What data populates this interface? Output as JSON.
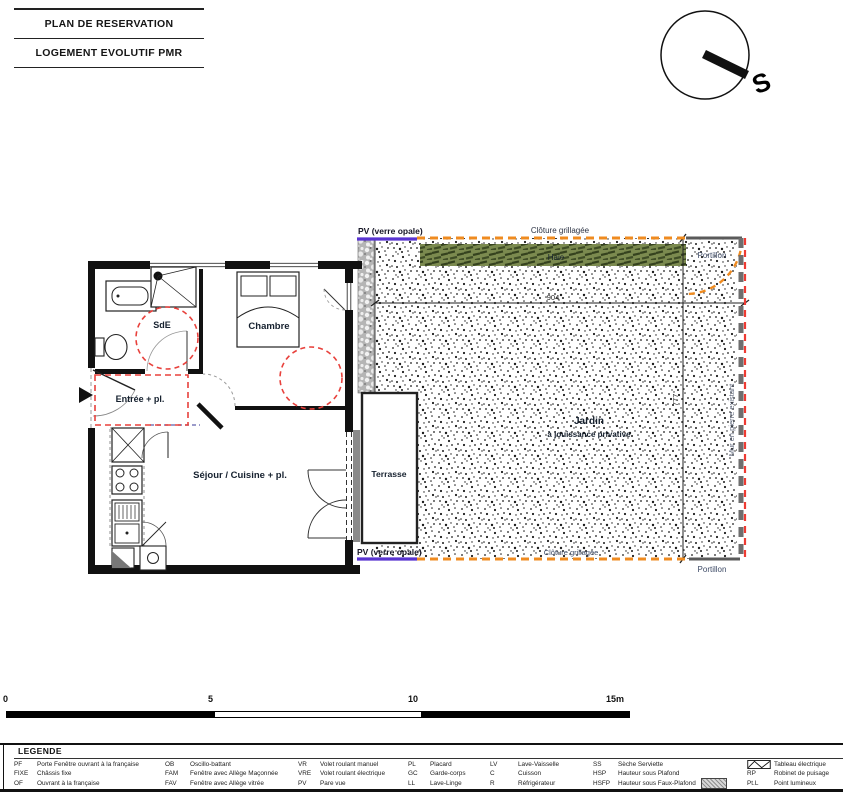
{
  "title_block": {
    "line1": "PLAN DE RESERVATION",
    "line2": "LOGEMENT EVOLUTIF PMR"
  },
  "north_arrow": {
    "letter": "S"
  },
  "plan": {
    "rooms": {
      "sde": "SdE",
      "chambre": "Chambre",
      "entree": "Entrée + pl.",
      "sejour": "Séjour / Cuisine + pl.",
      "terrasse": "Terrasse",
      "jardin_title": "Jardin",
      "jardin_subtitle": "à jouissance privative"
    },
    "annotations": {
      "pv_top": "PV (verre opale)",
      "pv_bottom": "PV (verre opale)",
      "cloture_top": "Clôture grillagée",
      "cloture_bottom": "Clôture grillagée",
      "haie": "Haie",
      "portillon_top": "Portillon",
      "portillon_bottom": "Portillon",
      "mur_existant": "Mur en pierre existant",
      "dim_width_cm": "904",
      "dim_depth_cm": "777"
    },
    "colors": {
      "pare_vue": "#5934d1",
      "cloture": "#ef8b20",
      "haie_fill": "#7b8a4f",
      "pmr_red": "#e8413c",
      "mur_red": "#ee3b33"
    }
  },
  "scale_bar": {
    "ticks": [
      "0",
      "5",
      "10",
      "15m"
    ]
  },
  "legend": {
    "title": "LEGENDE",
    "cols": [
      {
        "rows": [
          {
            "k": "PF",
            "v": "Porte Fenêtre ouvrant à la française"
          },
          {
            "k": "FIXE",
            "v": "Châssis fixe"
          },
          {
            "k": "OF",
            "v": "Ouvrant à la française"
          }
        ]
      },
      {
        "rows": [
          {
            "k": "OB",
            "v": "Oscillo-battant"
          },
          {
            "k": "FAM",
            "v": "Fenêtre avec Allège Maçonnée"
          },
          {
            "k": "FAV",
            "v": "Fenêtre avec Allège vitrée"
          }
        ]
      },
      {
        "rows": [
          {
            "k": "VR",
            "v": "Volet roulant manuel"
          },
          {
            "k": "VRE",
            "v": "Volet roulant électrique"
          },
          {
            "k": "PV",
            "v": "Pare vue"
          }
        ]
      },
      {
        "rows": [
          {
            "k": "PL",
            "v": "Placard"
          },
          {
            "k": "GC",
            "v": "Garde-corps"
          },
          {
            "k": "LL",
            "v": "Lave-Linge"
          }
        ]
      },
      {
        "rows": [
          {
            "k": "LV",
            "v": "Lave-Vaisselle"
          },
          {
            "k": "C",
            "v": "Cuisson"
          },
          {
            "k": "R",
            "v": "Réfrigérateur"
          }
        ]
      },
      {
        "rows": [
          {
            "k": "SS",
            "v": "Sèche Serviette"
          },
          {
            "k": "HSP",
            "v": "Hauteur sous Plafond"
          },
          {
            "k": "HSFP",
            "v": "Hauteur sous Faux-Plafond"
          }
        ]
      }
    ],
    "col7": {
      "tableau": "Tableau électrique",
      "rp_k": "RP",
      "rp_v": "Robinet de puisage",
      "ptl_k": "Pt.L",
      "ptl_v": "Point lumineux"
    }
  }
}
